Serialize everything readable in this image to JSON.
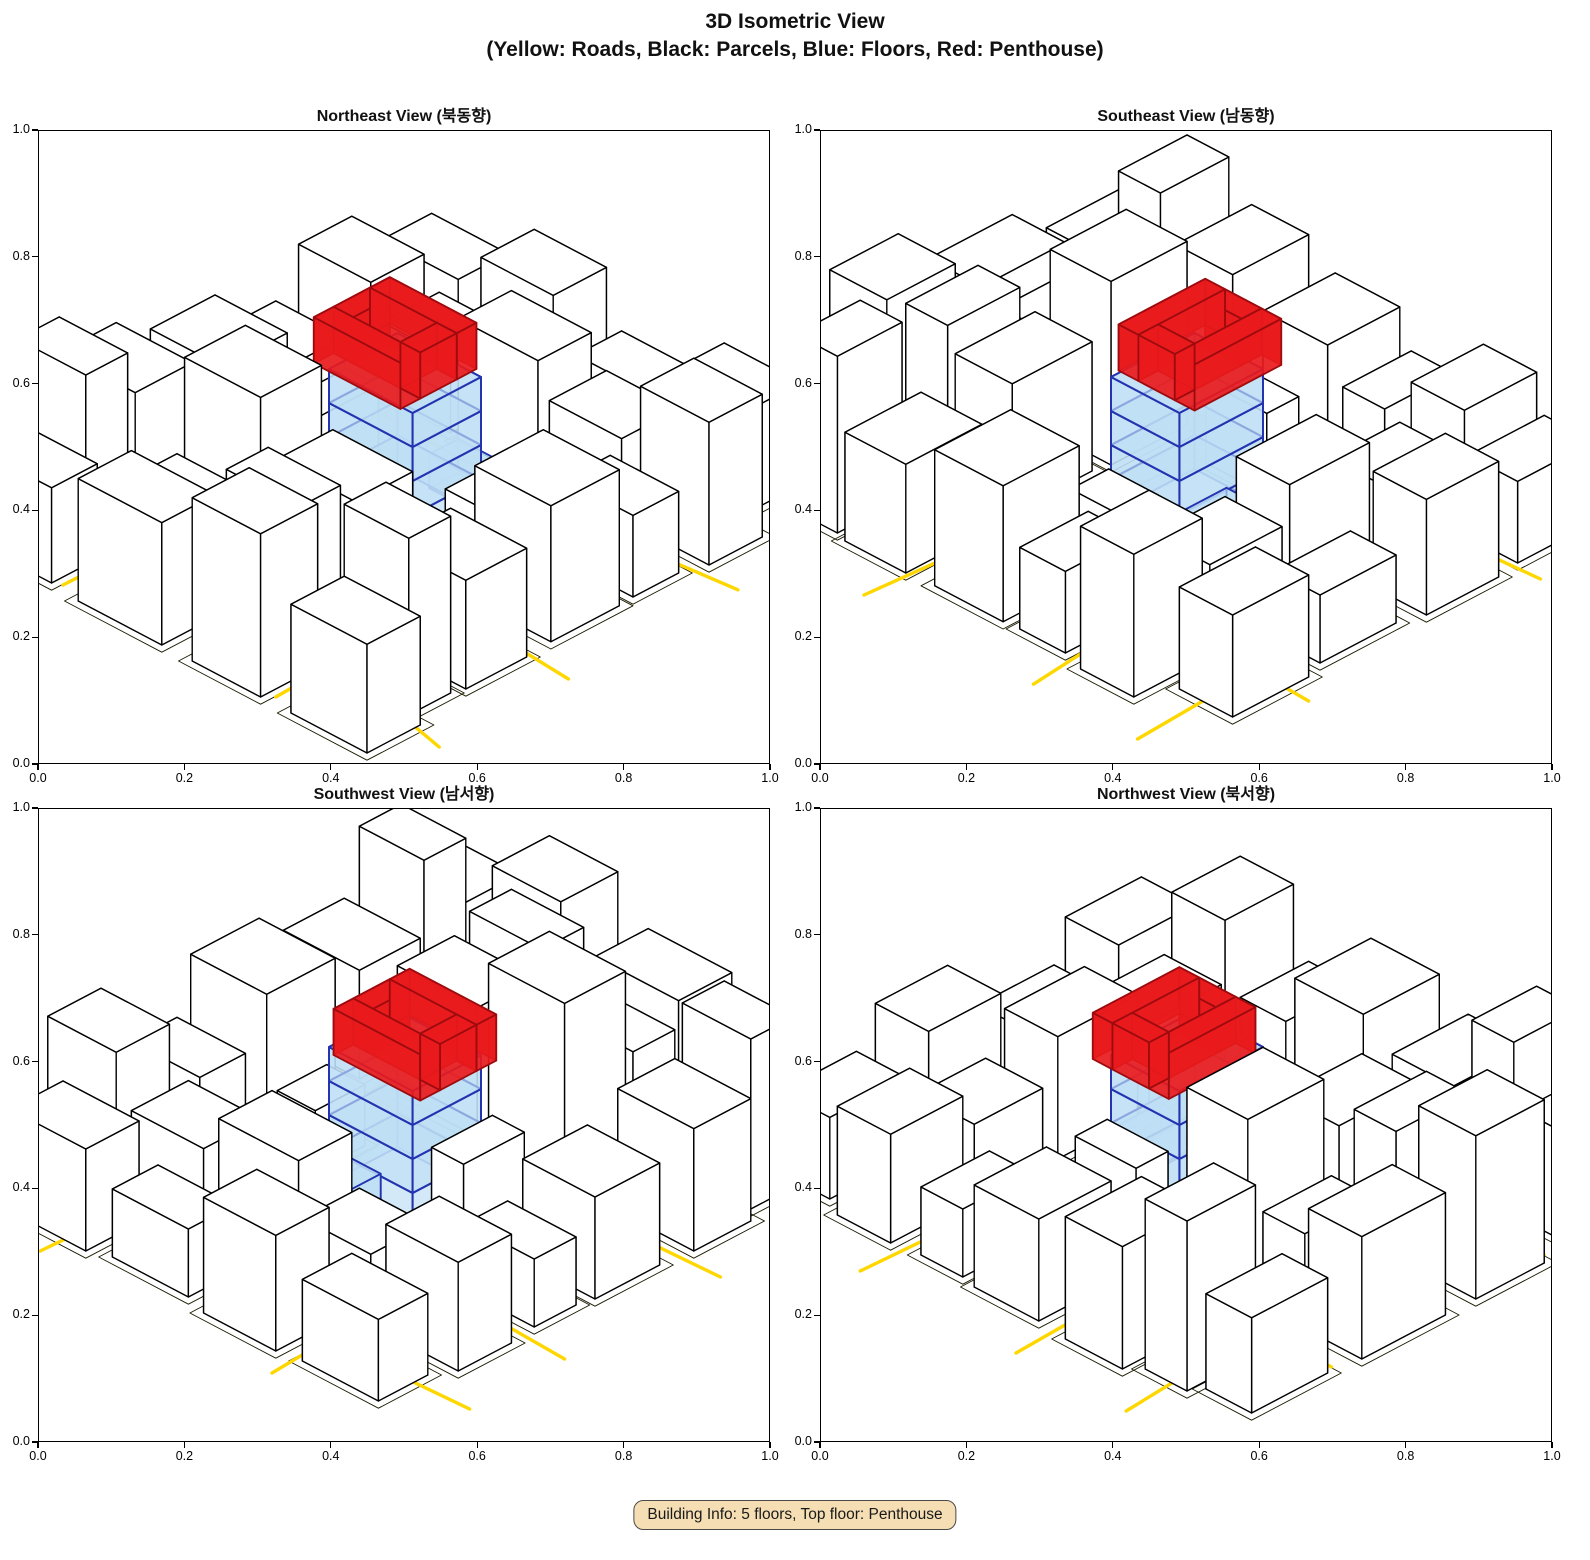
{
  "figure_title": {
    "line1": "3D Isometric View",
    "line2": "(Yellow: Roads, Black: Parcels, Blue: Floors, Red: Penthouse)"
  },
  "badge": {
    "text": "Building Info: 5 floors, Top floor: Penthouse",
    "background": "#F5DEB3",
    "border": "#4a4a4a"
  },
  "axis": {
    "tick_labels": [
      "0.0",
      "0.2",
      "0.4",
      "0.6",
      "0.8",
      "1.0"
    ],
    "min": 0.0,
    "max": 1.0
  },
  "colors": {
    "road": "#FFD700",
    "parcel_edge": "#000000",
    "parcel_line": "#1a1a00",
    "building_fill": "#ffffff",
    "floor_fill": "rgba(190,222,244,0.68)",
    "floor_edge": "#2433B0",
    "penthouse_fill": "rgba(233,26,28,0.92)",
    "penthouse_edge": "#9E0B0F",
    "badge_bg": "#F5DEB3"
  },
  "chart_data": {
    "type": "3d_isometric_city_views",
    "title": "3D Isometric View",
    "subtitle": "(Yellow: Roads, Black: Parcels, Blue: Floors, Red: Penthouse)",
    "legend": {
      "Yellow": "Roads",
      "Black": "Parcels",
      "Blue": "Floors",
      "Red": "Penthouse"
    },
    "axis_range": [
      0.0,
      1.0
    ],
    "axis_ticks": [
      0.0,
      0.2,
      0.4,
      0.6,
      0.8,
      1.0
    ],
    "building_info": {
      "floors": 5,
      "top_floor": "Penthouse",
      "blue_floor_count": 4,
      "penthouse_count": 1
    },
    "views": [
      {
        "label": "Northeast View (북동향)",
        "rotation_deg": 0
      },
      {
        "label": "Southeast View (남동향)",
        "rotation_deg": 90
      },
      {
        "label": "Southwest View (남서향)",
        "rotation_deg": 180
      },
      {
        "label": "Northwest View (북서향)",
        "rotation_deg": 270
      }
    ],
    "scene": {
      "buildings": [
        [
          -1.0,
          2.6,
          1.1,
          0.7,
          0.9
        ],
        [
          0.5,
          2.55,
          0.9,
          0.75,
          1.2
        ],
        [
          -2.4,
          2.65,
          1.0,
          0.6,
          0.7
        ],
        [
          1.8,
          2.6,
          1.0,
          0.7,
          0.8
        ],
        [
          -2.7,
          1.1,
          1.0,
          0.75,
          0.9
        ],
        [
          -2.55,
          2.0,
          0.9,
          0.55,
          1.25
        ],
        [
          -1.05,
          1.05,
          1.0,
          0.8,
          1.35
        ],
        [
          -1.0,
          2.0,
          0.9,
          0.55,
          0.7
        ],
        [
          0.15,
          1.1,
          1.05,
          0.75,
          0.95
        ],
        [
          0.2,
          2.0,
          0.95,
          0.55,
          1.1
        ],
        [
          1.65,
          1.05,
          1.0,
          0.8,
          0.8
        ],
        [
          1.75,
          2.0,
          0.85,
          0.55,
          1.3
        ],
        [
          -2.65,
          -0.15,
          0.95,
          0.85,
          0.75
        ],
        [
          -2.6,
          -0.9,
          0.9,
          0.55,
          0.5
        ],
        [
          -1.12,
          -0.35,
          0.42,
          0.8,
          0.6
        ],
        [
          0.78,
          -0.4,
          0.5,
          0.65,
          0.45
        ],
        [
          1.62,
          -0.2,
          1.0,
          0.9,
          1.0
        ],
        [
          1.7,
          -1.0,
          0.9,
          0.6,
          0.6
        ],
        [
          -2.65,
          -1.95,
          0.95,
          0.7,
          0.8
        ],
        [
          -1.55,
          -2.0,
          0.9,
          0.75,
          0.55
        ],
        [
          -0.5,
          -1.9,
          1.05,
          0.7,
          0.9
        ],
        [
          0.7,
          -1.95,
          0.95,
          0.75,
          0.65
        ],
        [
          1.8,
          -2.0,
          0.9,
          0.7,
          1.05
        ],
        [
          -2.5,
          -2.85,
          1.0,
          0.65,
          0.6
        ],
        [
          -1.2,
          -2.9,
          0.95,
          0.7,
          0.85
        ],
        [
          0.05,
          -2.8,
          1.0,
          0.6,
          0.5
        ],
        [
          1.3,
          -2.9,
          1.0,
          0.7,
          0.75
        ]
      ],
      "roads": [
        [
          [
            -3.2,
            0.95
          ],
          [
            -2.0,
            0.9
          ],
          [
            -0.8,
            0.86
          ],
          [
            0.6,
            0.88
          ],
          [
            1.9,
            0.95
          ],
          [
            3.2,
            1.05
          ]
        ],
        [
          [
            -3.2,
            -1.1
          ],
          [
            -1.8,
            -1.04
          ],
          [
            -0.4,
            -1.0
          ],
          [
            1.0,
            -1.02
          ],
          [
            2.2,
            -1.08
          ],
          [
            3.2,
            -1.18
          ]
        ],
        [
          [
            -1.3,
            3.2
          ],
          [
            -1.28,
            2.0
          ],
          [
            -1.25,
            0.9
          ],
          [
            -1.28,
            -0.2
          ],
          [
            -1.32,
            -1.05
          ],
          [
            -1.38,
            -2.1
          ],
          [
            -1.45,
            -3.2
          ]
        ],
        [
          [
            1.5,
            3.2
          ],
          [
            1.45,
            2.0
          ],
          [
            1.42,
            0.9
          ],
          [
            1.45,
            -0.2
          ],
          [
            1.5,
            -1.05
          ],
          [
            1.55,
            -2.1
          ],
          [
            1.6,
            -3.2
          ]
        ],
        [
          [
            -3.2,
            2.4
          ],
          [
            -1.9,
            2.3
          ],
          [
            -0.5,
            2.28
          ],
          [
            0.9,
            2.35
          ],
          [
            2.1,
            2.5
          ],
          [
            3.2,
            2.75
          ]
        ],
        [
          [
            -3.2,
            -2.35
          ],
          [
            -1.7,
            -2.42
          ],
          [
            -0.2,
            -2.38
          ],
          [
            1.2,
            -2.45
          ],
          [
            3.2,
            -2.55
          ]
        ]
      ],
      "target": {
        "rect": [
          -0.55,
          -0.45,
          1.1,
          0.9
        ],
        "floor_count": 4,
        "floor_height": 0.25,
        "annex": [
          -0.1,
          -0.8,
          0.55,
          0.38,
          0.25
        ],
        "penthouse": {
          "rect": [
            -0.72,
            -0.52,
            1.14,
            1.0
          ],
          "wall": 0.26,
          "z0": 1.0,
          "height": 0.34
        }
      }
    }
  }
}
